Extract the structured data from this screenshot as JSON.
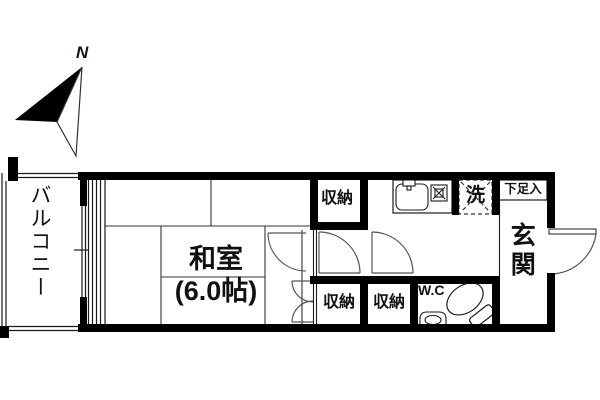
{
  "compass": {
    "label": "N"
  },
  "rooms": {
    "balcony": {
      "label": "バルコニー"
    },
    "japanese_room": {
      "label": "和室",
      "size": "(6.0帖)"
    },
    "storage_top": {
      "label": "収納"
    },
    "storage_bottom_left": {
      "label": "収納"
    },
    "storage_bottom_right": {
      "label": "収納"
    },
    "wc": {
      "label": "W.C"
    },
    "washer": {
      "label": "洗"
    },
    "shoe_storage": {
      "label": "下足入"
    },
    "entrance": {
      "label": "玄関"
    }
  },
  "icons": [
    "north-arrow-icon",
    "kitchen-sink-icon",
    "stove-icon",
    "toilet-icon",
    "hand-basin-icon"
  ],
  "colors": {
    "wall": "#000000",
    "thin_line": "#1a1a1a",
    "door_arc": "#555555",
    "text": "#111111"
  }
}
